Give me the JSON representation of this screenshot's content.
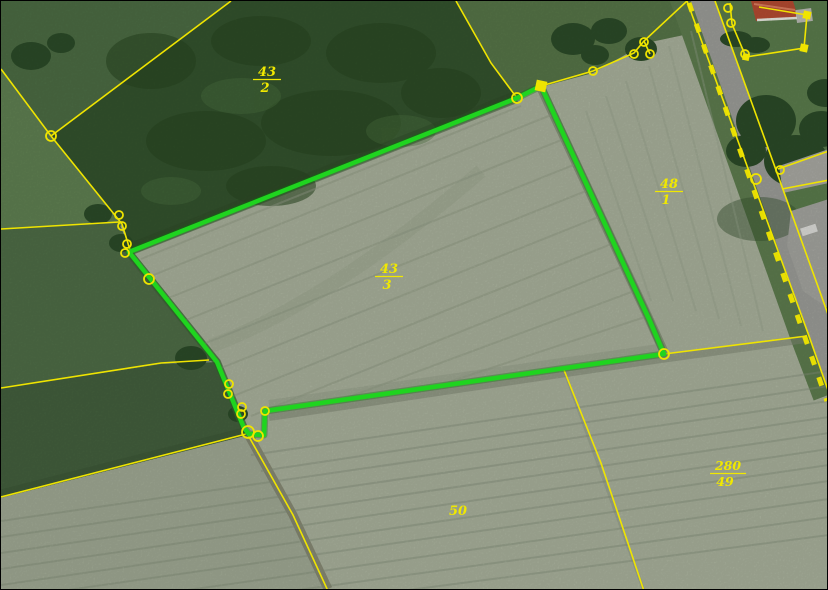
{
  "map": {
    "view": "aerial-cadastral-parcels",
    "highlight_color": "#1fd41f",
    "boundary_color": "#efe400",
    "label_color": "#f0e800",
    "highlighted_parcel": "43/3",
    "parcel_labels": [
      {
        "id": "43/2",
        "numerator": "43",
        "denominator": "2"
      },
      {
        "id": "43/3",
        "numerator": "43",
        "denominator": "3"
      },
      {
        "id": "48/1",
        "numerator": "48",
        "denominator": "1"
      },
      {
        "id": "280/49",
        "numerator": "280",
        "denominator": "49"
      },
      {
        "id": "50",
        "number": "50"
      }
    ],
    "vertex_markers": [
      {
        "x": 516,
        "y": 97,
        "r": 5
      },
      {
        "x": 592,
        "y": 70,
        "r": 4
      },
      {
        "x": 633,
        "y": 53,
        "r": 4
      },
      {
        "x": 643,
        "y": 41,
        "r": 4
      },
      {
        "x": 649,
        "y": 53,
        "r": 4
      },
      {
        "x": 50,
        "y": 135,
        "r": 5
      },
      {
        "x": 118,
        "y": 214,
        "r": 4
      },
      {
        "x": 121,
        "y": 225,
        "r": 4
      },
      {
        "x": 126,
        "y": 243,
        "r": 4
      },
      {
        "x": 124,
        "y": 252,
        "r": 4
      },
      {
        "x": 148,
        "y": 278,
        "r": 5
      },
      {
        "x": 228,
        "y": 383,
        "r": 4
      },
      {
        "x": 227,
        "y": 393,
        "r": 4
      },
      {
        "x": 241,
        "y": 406,
        "r": 4
      },
      {
        "x": 240,
        "y": 413,
        "r": 4
      },
      {
        "x": 247,
        "y": 431,
        "r": 6
      },
      {
        "x": 257,
        "y": 435,
        "r": 5
      },
      {
        "x": 264,
        "y": 410,
        "r": 4
      },
      {
        "x": 663,
        "y": 353,
        "r": 5
      },
      {
        "x": 727,
        "y": 7,
        "r": 4
      },
      {
        "x": 730,
        "y": 22,
        "r": 4
      },
      {
        "x": 744,
        "y": 53,
        "r": 4
      },
      {
        "x": 755,
        "y": 178,
        "r": 5
      },
      {
        "x": 779,
        "y": 169,
        "r": 4
      }
    ],
    "square_markers": [
      {
        "x": 540,
        "y": 85,
        "s": 9
      },
      {
        "x": 803,
        "y": 47,
        "s": 6
      },
      {
        "x": 806,
        "y": 14,
        "s": 6
      },
      {
        "x": 745,
        "y": 56,
        "s": 5
      }
    ]
  }
}
